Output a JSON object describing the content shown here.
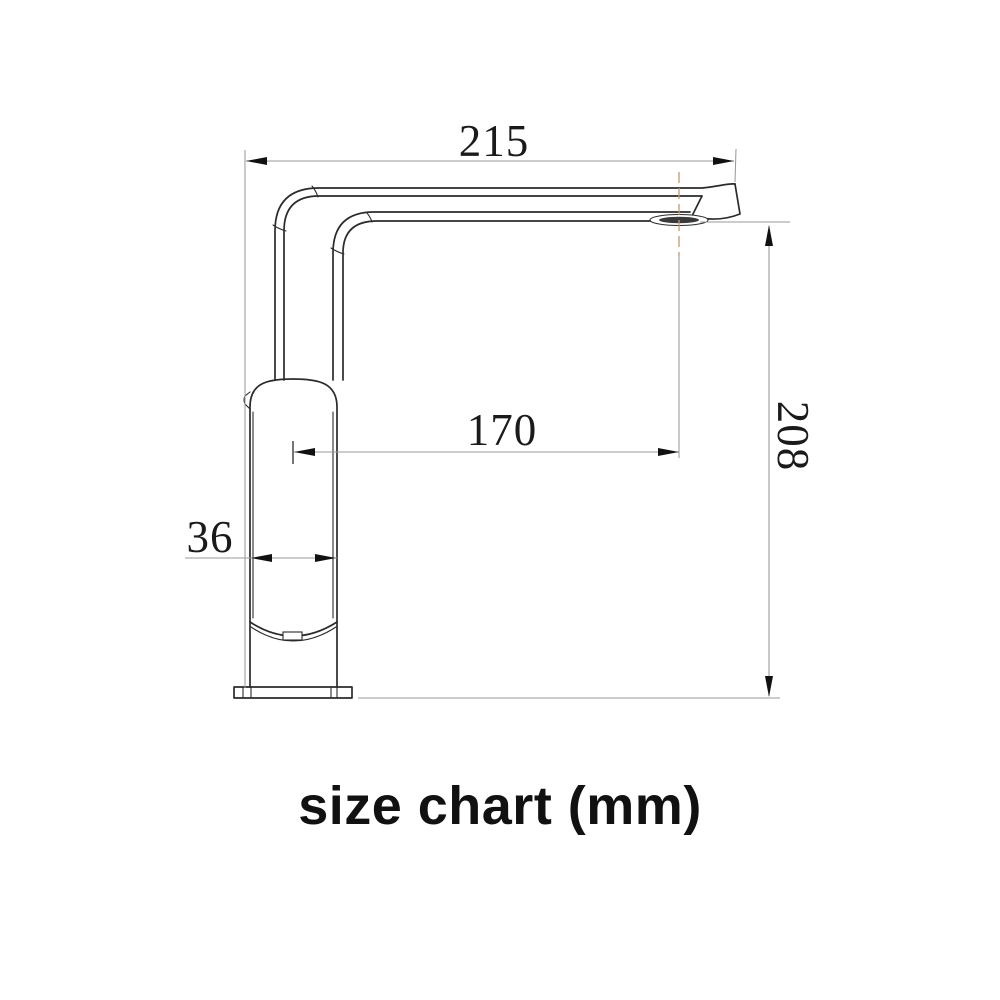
{
  "diagram": {
    "caption": "size chart (mm)",
    "unit": "mm",
    "subject": "faucet-side-view-technical-drawing",
    "dimensions": [
      {
        "id": "overall-reach-top",
        "label": "215",
        "orientation": "horizontal",
        "position": "top"
      },
      {
        "id": "spout-outlet-offset",
        "label": "170",
        "orientation": "horizontal",
        "position": "middle"
      },
      {
        "id": "body-width",
        "label": "36",
        "orientation": "horizontal",
        "position": "left"
      },
      {
        "id": "overall-height",
        "label": "208",
        "orientation": "vertical",
        "position": "right"
      }
    ],
    "colors": {
      "background": "#ffffff",
      "object_line": "#2b2b2b",
      "dimension_line": "#9a9a9a",
      "arrow": "#111111",
      "centerline": "#c49a6c",
      "text": "#1a1a1a"
    }
  }
}
